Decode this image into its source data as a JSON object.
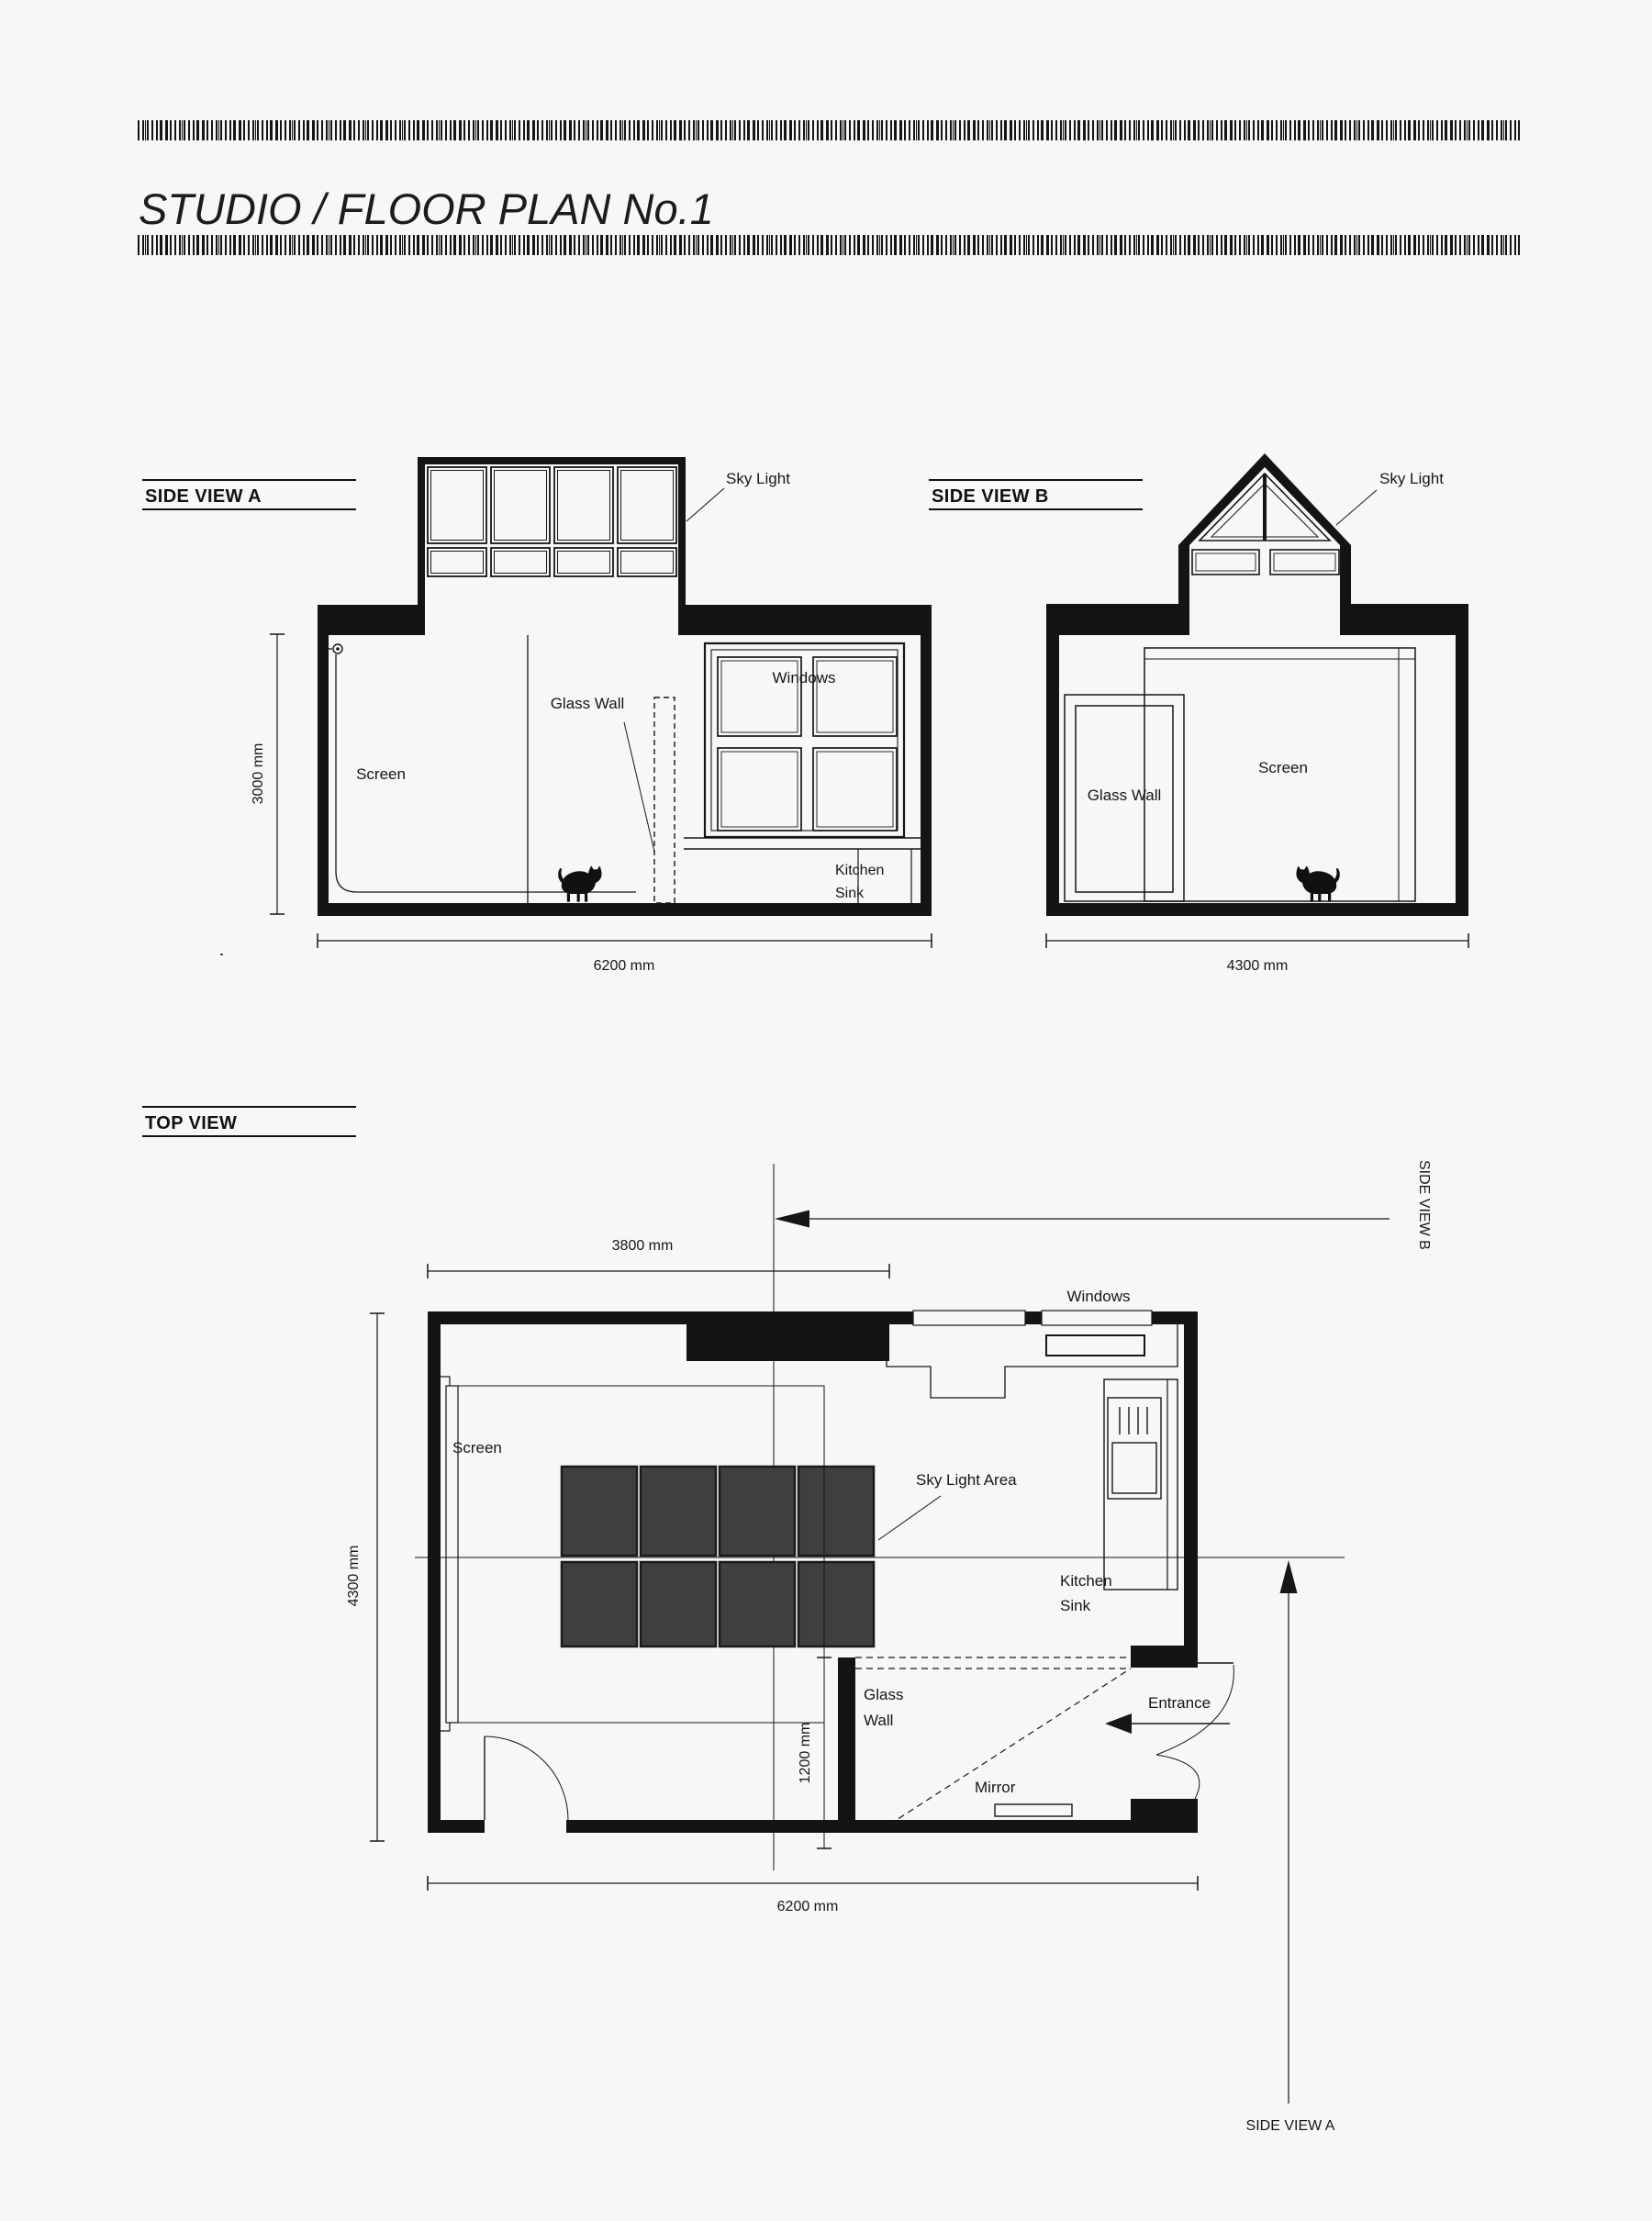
{
  "page": {
    "title": "STUDIO / FLOOR PLAN No.1"
  },
  "colors": {
    "ink": "#161616",
    "paper": "#f7f7f5",
    "wall": "#141414",
    "skylight_fill": "#3f3f3f"
  },
  "side_view_a": {
    "heading": "SIDE VIEW A",
    "labels": {
      "sky_light": "Sky Light",
      "glass_wall": "Glass Wall",
      "windows": "Windows",
      "screen": "Screen",
      "kitchen": "Kitchen",
      "sink": "Sink"
    },
    "dims": {
      "height": "3000 mm",
      "width": "6200 mm"
    }
  },
  "side_view_b": {
    "heading": "SIDE VIEW B",
    "labels": {
      "sky_light": "Sky Light",
      "glass_wall": "Glass Wall",
      "screen": "Screen"
    },
    "dims": {
      "width": "4300 mm"
    }
  },
  "top_view": {
    "heading": "TOP VIEW",
    "labels": {
      "windows": "Windows",
      "screen": "Screen",
      "sky_light_area": "Sky Light Area",
      "kitchen": "Kitchen",
      "sink": "Sink",
      "glass": "Glass",
      "wall": "Wall",
      "entrance": "Entrance",
      "mirror": "Mirror"
    },
    "dims": {
      "top_width": "3800 mm",
      "height": "4300 mm",
      "glass_depth": "1200 mm",
      "width": "6200 mm"
    },
    "view_markers": {
      "side_view_b": "SIDE VIEW B",
      "side_view_a": "SIDE VIEW A"
    }
  }
}
